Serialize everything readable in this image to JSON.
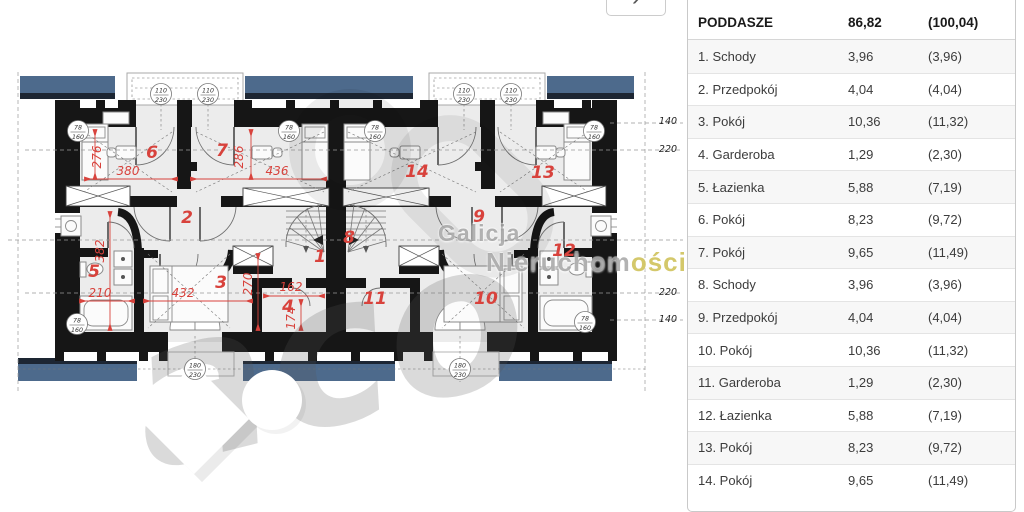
{
  "carousel": {
    "next": "›"
  },
  "schedule": {
    "header": {
      "name": "PODDASZE",
      "area": "86,82",
      "total": "(100,04)"
    },
    "rows": [
      {
        "name": "1. Schody",
        "area": "3,96",
        "gross": "(3,96)"
      },
      {
        "name": "2. Przedpokój",
        "area": "4,04",
        "gross": "(4,04)"
      },
      {
        "name": "3. Pokój",
        "area": "10,36",
        "gross": "(11,32)"
      },
      {
        "name": "4. Garderoba",
        "area": "1,29",
        "gross": "(2,30)"
      },
      {
        "name": "5. Łazienka",
        "area": "5,88",
        "gross": "(7,19)"
      },
      {
        "name": "6. Pokój",
        "area": "8,23",
        "gross": "(9,72)"
      },
      {
        "name": "7. Pokój",
        "area": "9,65",
        "gross": "(11,49)"
      },
      {
        "name": "8. Schody",
        "area": "3,96",
        "gross": "(3,96)"
      },
      {
        "name": "9. Przedpokój",
        "area": "4,04",
        "gross": "(4,04)"
      },
      {
        "name": "10. Pokój",
        "area": "10,36",
        "gross": "(11,32)"
      },
      {
        "name": "11. Garderoba",
        "area": "1,29",
        "gross": "(2,30)"
      },
      {
        "name": "12. Łazienka",
        "area": "5,88",
        "gross": "(7,19)"
      },
      {
        "name": "13. Pokój",
        "area": "8,23",
        "gross": "(9,72)"
      },
      {
        "name": "14. Pokój",
        "area": "9,65",
        "gross": "(11,49)"
      }
    ]
  },
  "plan": {
    "rooms": [
      {
        "n": "1",
        "x": 320,
        "y": 262
      },
      {
        "n": "2",
        "x": 187,
        "y": 223
      },
      {
        "n": "3",
        "x": 221,
        "y": 288
      },
      {
        "n": "4",
        "x": 288,
        "y": 312
      },
      {
        "n": "5",
        "x": 94,
        "y": 277
      },
      {
        "n": "6",
        "x": 152,
        "y": 158
      },
      {
        "n": "7",
        "x": 222,
        "y": 156
      },
      {
        "n": "8",
        "x": 349,
        "y": 243
      },
      {
        "n": "9",
        "x": 479,
        "y": 222
      },
      {
        "n": "10",
        "x": 486,
        "y": 304
      },
      {
        "n": "11",
        "x": 375,
        "y": 304
      },
      {
        "n": "12",
        "x": 564,
        "y": 256
      },
      {
        "n": "13",
        "x": 543,
        "y": 178
      },
      {
        "n": "14",
        "x": 417,
        "y": 177
      }
    ],
    "dims": [
      {
        "t": "276",
        "x": 101,
        "y": 157,
        "r": -90
      },
      {
        "t": "380",
        "x": 128,
        "y": 175
      },
      {
        "t": "286",
        "x": 243,
        "y": 157,
        "r": -90
      },
      {
        "t": "436",
        "x": 277,
        "y": 175
      },
      {
        "t": "382",
        "x": 104,
        "y": 251,
        "r": -90
      },
      {
        "t": "210",
        "x": 100,
        "y": 297
      },
      {
        "t": "432",
        "x": 183,
        "y": 297
      },
      {
        "t": "270",
        "x": 252,
        "y": 284,
        "r": -90
      },
      {
        "t": "162",
        "x": 291,
        "y": 291
      },
      {
        "t": "174",
        "x": 295,
        "y": 318,
        "r": -90
      }
    ],
    "margin_dims": [
      {
        "t": "140",
        "x": 668,
        "y": 124
      },
      {
        "t": "220",
        "x": 668,
        "y": 152
      },
      {
        "t": "220",
        "x": 668,
        "y": 295
      },
      {
        "t": "140",
        "x": 668,
        "y": 322
      }
    ],
    "windows": [
      {
        "w": "110",
        "h": "230",
        "x": 161,
        "y": 94
      },
      {
        "w": "110",
        "h": "230",
        "x": 208,
        "y": 94
      },
      {
        "w": "110",
        "h": "230",
        "x": 464,
        "y": 94
      },
      {
        "w": "110",
        "h": "230",
        "x": 511,
        "y": 94
      },
      {
        "w": "78",
        "h": "160",
        "x": 78,
        "y": 131
      },
      {
        "w": "78",
        "h": "160",
        "x": 289,
        "y": 131
      },
      {
        "w": "78",
        "h": "160",
        "x": 375,
        "y": 131
      },
      {
        "w": "78",
        "h": "160",
        "x": 594,
        "y": 131
      },
      {
        "w": "78",
        "h": "160",
        "x": 77,
        "y": 324
      },
      {
        "w": "78",
        "h": "160",
        "x": 585,
        "y": 322
      },
      {
        "w": "180",
        "h": "230",
        "x": 195,
        "y": 369
      },
      {
        "w": "180",
        "h": "230",
        "x": 460,
        "y": 369
      }
    ],
    "watermark": {
      "line1": "Galicja",
      "line2_gray": "Nieruchom",
      "line2_yellow": "ości",
      "big_letters": "aco"
    }
  }
}
